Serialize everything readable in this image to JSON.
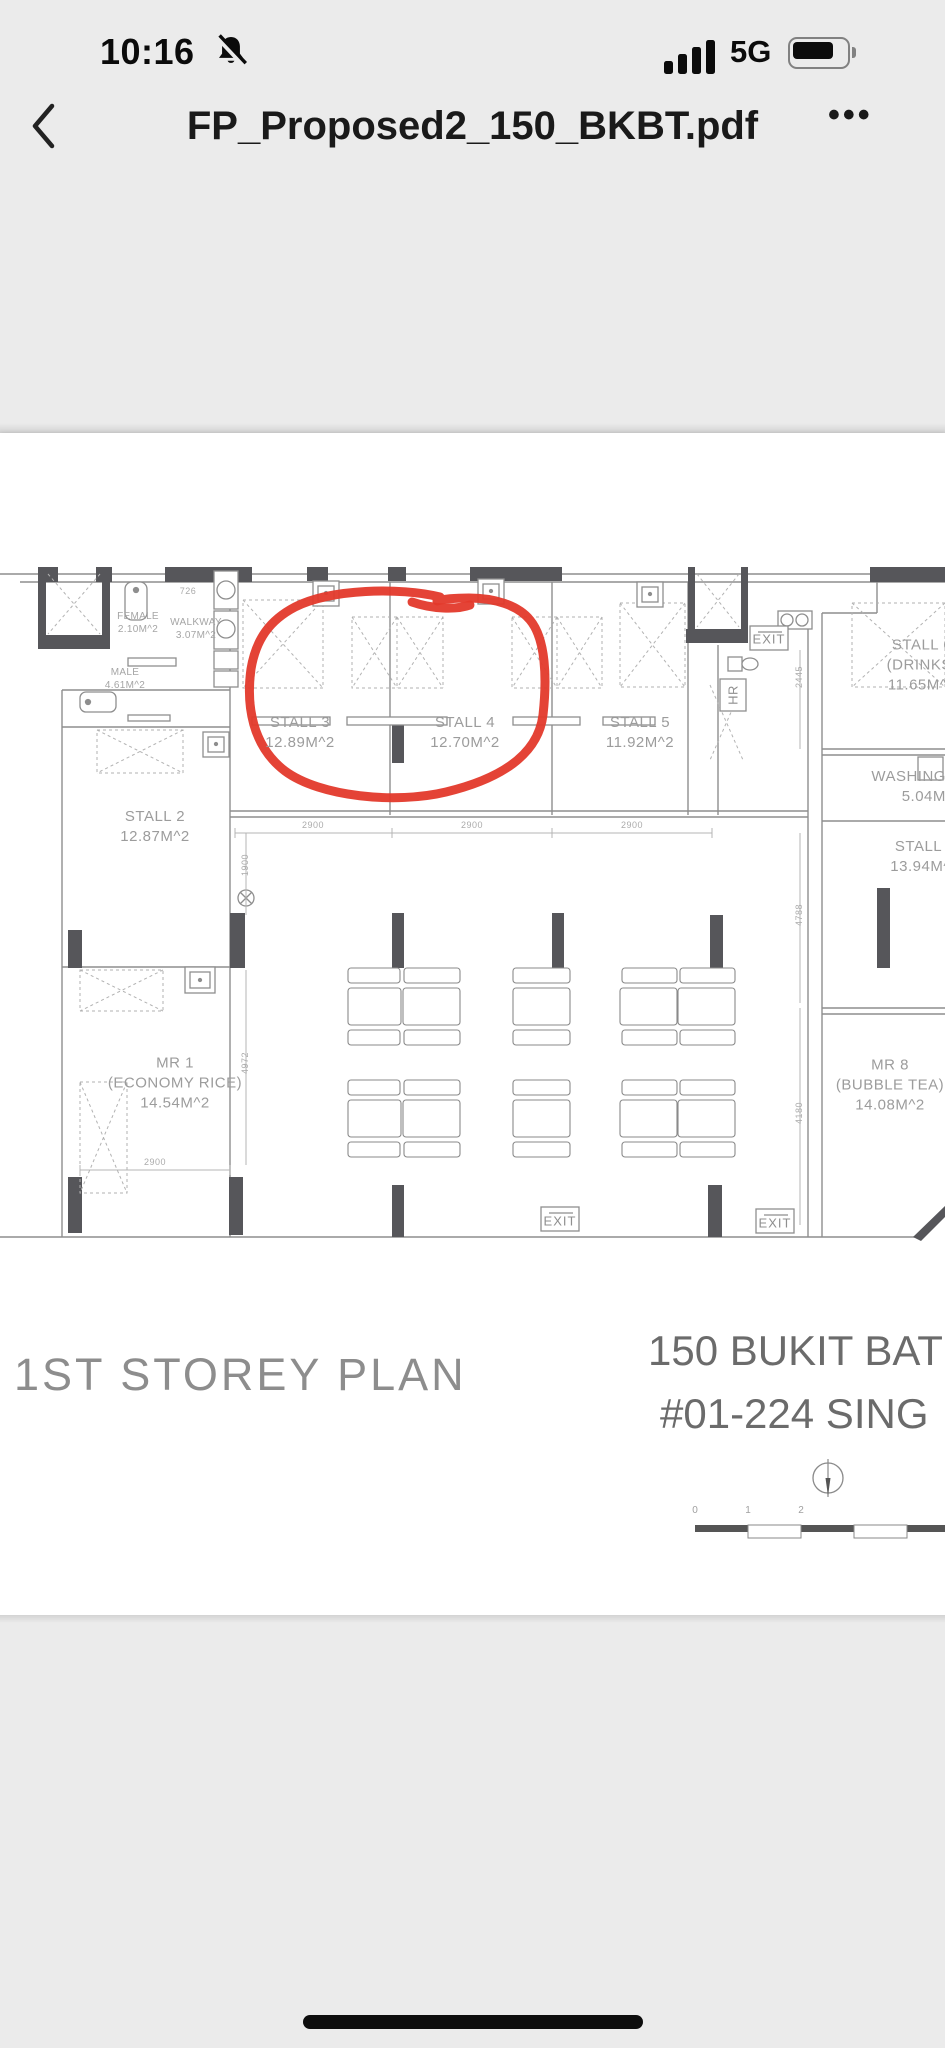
{
  "status_bar": {
    "time": "10:16",
    "network": "5G"
  },
  "nav_bar": {
    "title": "FP_Proposed2_150_BKBT.pdf",
    "menu": "•••"
  },
  "plan": {
    "rooms": {
      "female": {
        "name": "FEMALE",
        "area": "2.10M^2"
      },
      "walkway": {
        "name": "WALKWAY",
        "area": "3.07M^2"
      },
      "male": {
        "name": "MALE",
        "area": "4.61M^2"
      },
      "stall2": {
        "name": "STALL 2",
        "area": "12.87M^2"
      },
      "stall3": {
        "name": "STALL 3",
        "area": "12.89M^2"
      },
      "stall4": {
        "name": "STALL 4",
        "area": "12.70M^2"
      },
      "stall5": {
        "name": "STALL 5",
        "area": "11.92M^2"
      },
      "stall6": {
        "name": "STALL 6",
        "subtitle": "(DRINKS)",
        "area": "11.65M^2"
      },
      "washing": {
        "name": "WASHING AREA",
        "area": "5.04M^2"
      },
      "stall7": {
        "name": "STALL 7",
        "area": "13.94M^2"
      },
      "mr1": {
        "name": "MR 1",
        "subtitle": "(ECONOMY RICE)",
        "area": "14.54M^2"
      },
      "mr8": {
        "name": "MR 8",
        "subtitle": "(BUBBLE TEA)",
        "area": "14.08M^2"
      }
    },
    "signs": {
      "exit": "EXIT",
      "hr": "HR"
    },
    "dims": {
      "walkway_width": "726",
      "stall_width": "2900",
      "seating_left": "1900",
      "right_top": "2445",
      "right_mid": "4788",
      "right_low": "4180",
      "mr1_width": "2900",
      "mr1_height": "4972"
    },
    "annotation_color": "#e3392b"
  },
  "footer": {
    "plan_title": "1ST STOREY PLAN",
    "address_line1": "150 BUKIT BAT",
    "address_line2": "#01-224 SING",
    "scale_ticks": [
      "0",
      "1",
      "2"
    ]
  }
}
